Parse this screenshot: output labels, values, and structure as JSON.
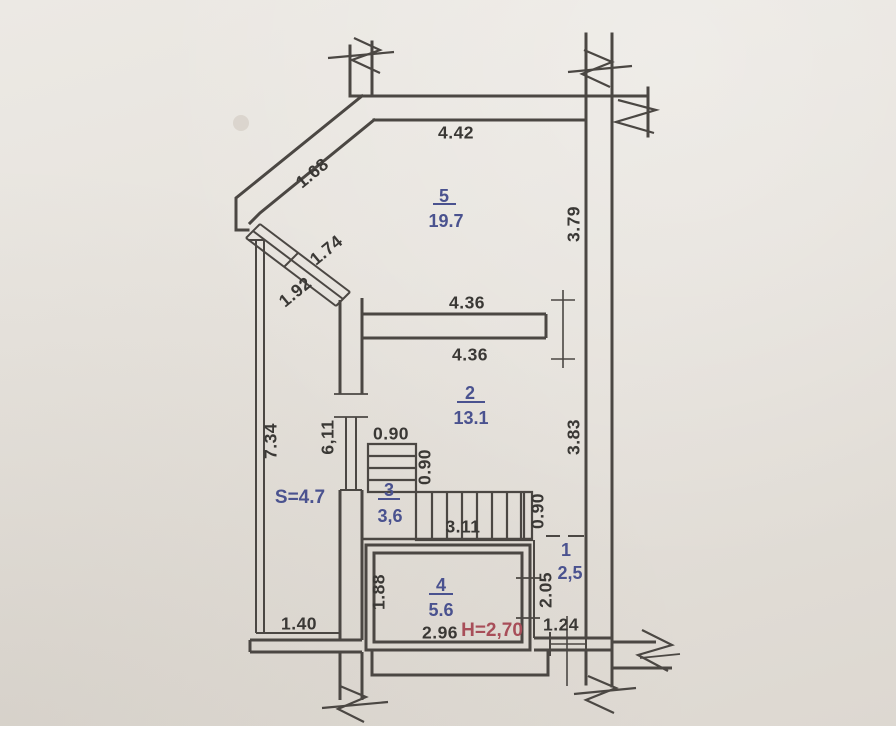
{
  "drawing": {
    "type": "apartment floor plan (technical passport sheet)",
    "colors": {
      "paper": "#e6e2dc",
      "wall_line": "#4b4743",
      "room_label": "#4a528f",
      "height_label": "#a84e59",
      "dimension_label": "#3a3835"
    }
  },
  "rooms": [
    {
      "number": "5",
      "area": "19.7"
    },
    {
      "number": "2",
      "area": "13.1"
    },
    {
      "number": "3",
      "area": "3,6"
    },
    {
      "number": "4",
      "area": "5.6"
    },
    {
      "number": "1",
      "area": "2,5"
    }
  ],
  "balcony": {
    "label": "S=4.7"
  },
  "height_note": "H=2,70",
  "dimensions": {
    "top_wall": "4.42",
    "diagonal_wall": "1.68",
    "bay_window_upper": "1.74",
    "bay_window_lower": "1.92",
    "right_wall_upper": "3.79",
    "partition_above": "4.36",
    "partition_below": "4.36",
    "right_wall_lower": "3.83",
    "balcony_length": "7.34",
    "inner_wall_length": "6,11",
    "stair_upper_width": "0.90",
    "stair_upper_run": "0.90",
    "stair_run": "3.11",
    "stair_lower_width": "0.90",
    "room4_depth": "1.88",
    "room1_depth": "2.05",
    "room4_width": "2.96",
    "room1_width": "1.24",
    "balcony_width": "1.40"
  }
}
